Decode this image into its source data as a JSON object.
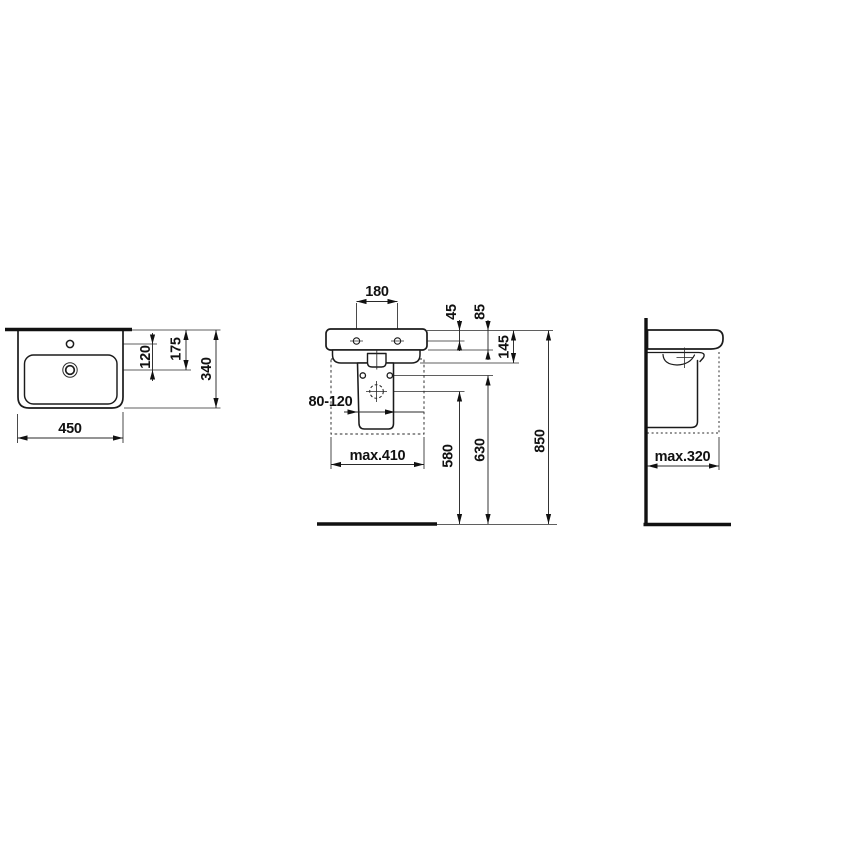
{
  "drawing": {
    "type": "washbasin installation drawing",
    "line_color": "#1b1b1b",
    "background": "#ffffff",
    "dims": {
      "plan": {
        "width": "450",
        "tap_to_drain": "120",
        "edge_to_drain": "175",
        "depth": "340"
      },
      "front": {
        "hole_spacing": "180",
        "top_to_fixing_holes": "45",
        "top_to_rim_bottom": "85",
        "top_to_body_bottom": "145",
        "waste_range": "80-120",
        "max_width": "max.410",
        "waste_height": "580",
        "pedestal_fixing_height": "630",
        "rim_height": "850"
      },
      "side": {
        "max_depth": "max.320"
      }
    }
  }
}
